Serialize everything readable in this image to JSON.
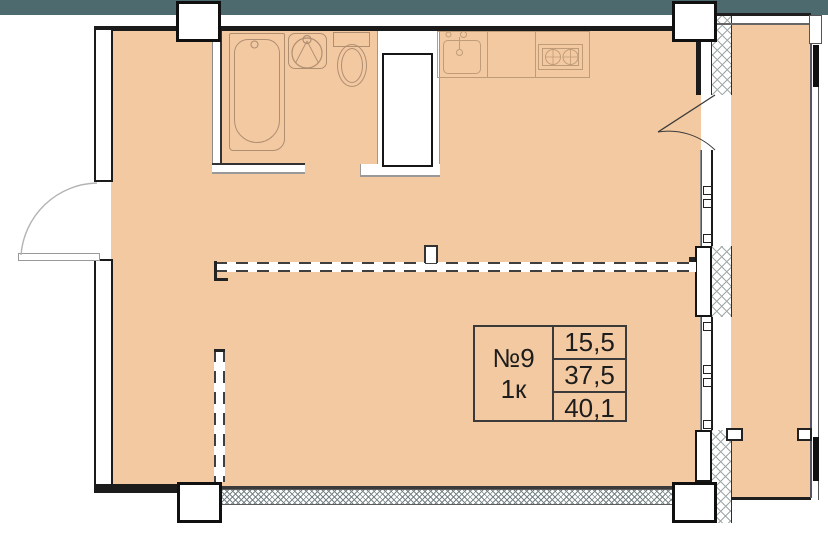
{
  "colors": {
    "floor": "#f3c9a1",
    "top_bar": "#4d6b6e",
    "walls": "#1b1b1b",
    "fixtures": "#b08e72",
    "kitchen_outline": "#bf9c77",
    "hatch": "#9fa8a8",
    "dash": "#3f3f3f"
  },
  "unit_card": {
    "unit_number": "№9",
    "rooms_label": "1к",
    "area_values": [
      "15,5",
      "37,5",
      "40,1"
    ]
  }
}
